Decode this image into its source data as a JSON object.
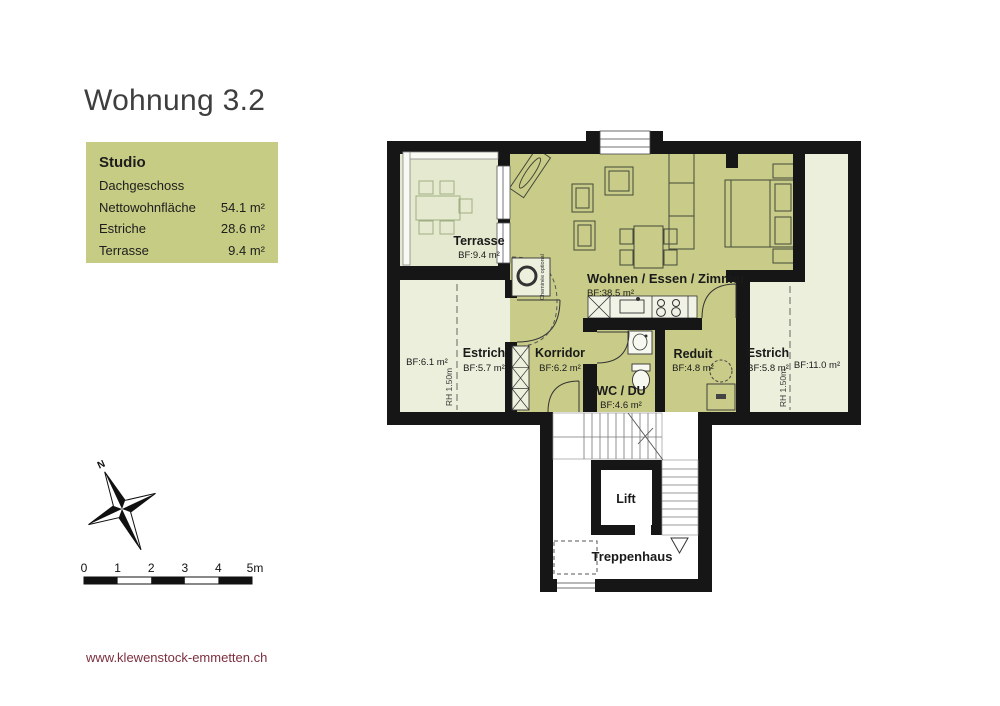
{
  "page": {
    "title": "Wohnung 3.2",
    "website": "www.klewenstock-emmetten.ch"
  },
  "info_box": {
    "heading": "Studio",
    "floor": "Dachgeschoss",
    "rows": [
      {
        "label": "Nettowohnfläche",
        "value": "54.1 m²"
      },
      {
        "label": "Estriche",
        "value": "28.6 m²"
      },
      {
        "label": "Terrasse",
        "value": "9.4 m²"
      }
    ]
  },
  "floorplan": {
    "labels": {
      "terrasse": {
        "name": "Terrasse",
        "area": "BF:9.4 m²"
      },
      "wohnen": {
        "name": "Wohnen / Essen / Zimmer",
        "area": "BF:38.5 m²"
      },
      "estrich_left": {
        "name": "Estrich",
        "area": "BF:5.7 m²",
        "area2": "BF:6.1 m²",
        "height_note": "RH 1.50m"
      },
      "korridor": {
        "name": "Korridor",
        "area": "BF:6.2 m²"
      },
      "wc": {
        "name": "WC / DU",
        "area": "BF:4.6 m²"
      },
      "reduit": {
        "name": "Reduit",
        "area": "BF:4.8 m²"
      },
      "estrich_right": {
        "name": "Estrich",
        "area": "BF:5.8 m²",
        "area2": "BF:11.0 m²",
        "height_note": "RH 1.50m"
      },
      "lift": {
        "name": "Lift"
      },
      "treppenhaus": {
        "name": "Treppenhaus"
      },
      "cheminee_note": "Cheminée optional",
      "north": "N"
    },
    "colors": {
      "living": "#c8cc88",
      "attic": "#ecefdb",
      "terrace": "#e4e9cf",
      "wall": "#161616",
      "info_box_bg": "#c6cc83",
      "footer_text": "#7d2f3f"
    }
  },
  "scalebar": {
    "unit_labels": [
      "0",
      "1",
      "2",
      "3",
      "4",
      "5m"
    ]
  }
}
